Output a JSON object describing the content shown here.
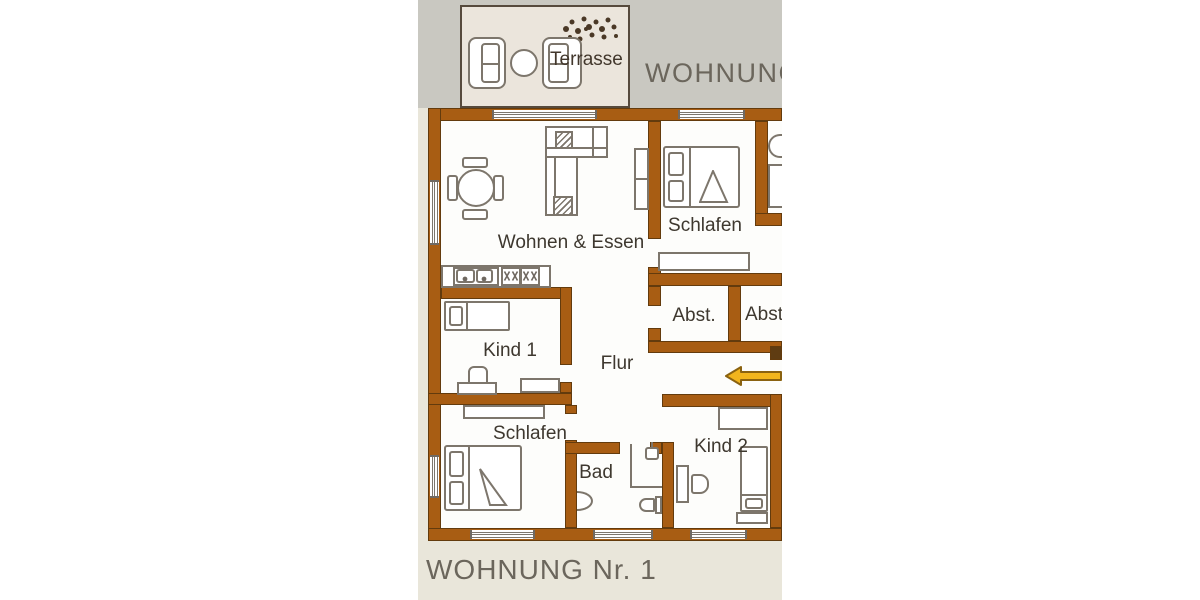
{
  "plan": {
    "header_partial": "WOHNUNG N",
    "footer_title": "WOHNUNG Nr. 1",
    "terrace_label": "Terrasse",
    "rooms": {
      "living": "Wohnen & Essen",
      "bedroom_top": "Schlafen",
      "storage_left": "Abst.",
      "storage_right": "Abst.",
      "hall": "Flur",
      "child1": "Kind 1",
      "bedroom_bottom": "Schlafen",
      "bath": "Bad",
      "child2": "Kind 2"
    },
    "colors": {
      "wall": "#a85d13",
      "wallEdge": "#633b0d",
      "jamb": "#5f3c12",
      "gray": "#c9c8c1",
      "beige": "#e9e6da",
      "terr": "#ebe5dc",
      "terrEdge": "#564a3d",
      "furn": "#7d766c",
      "label": "#3e382f",
      "header": "#6b665c",
      "arrow": "#f2b51d",
      "arrowEdge": "#8a6210"
    }
  }
}
